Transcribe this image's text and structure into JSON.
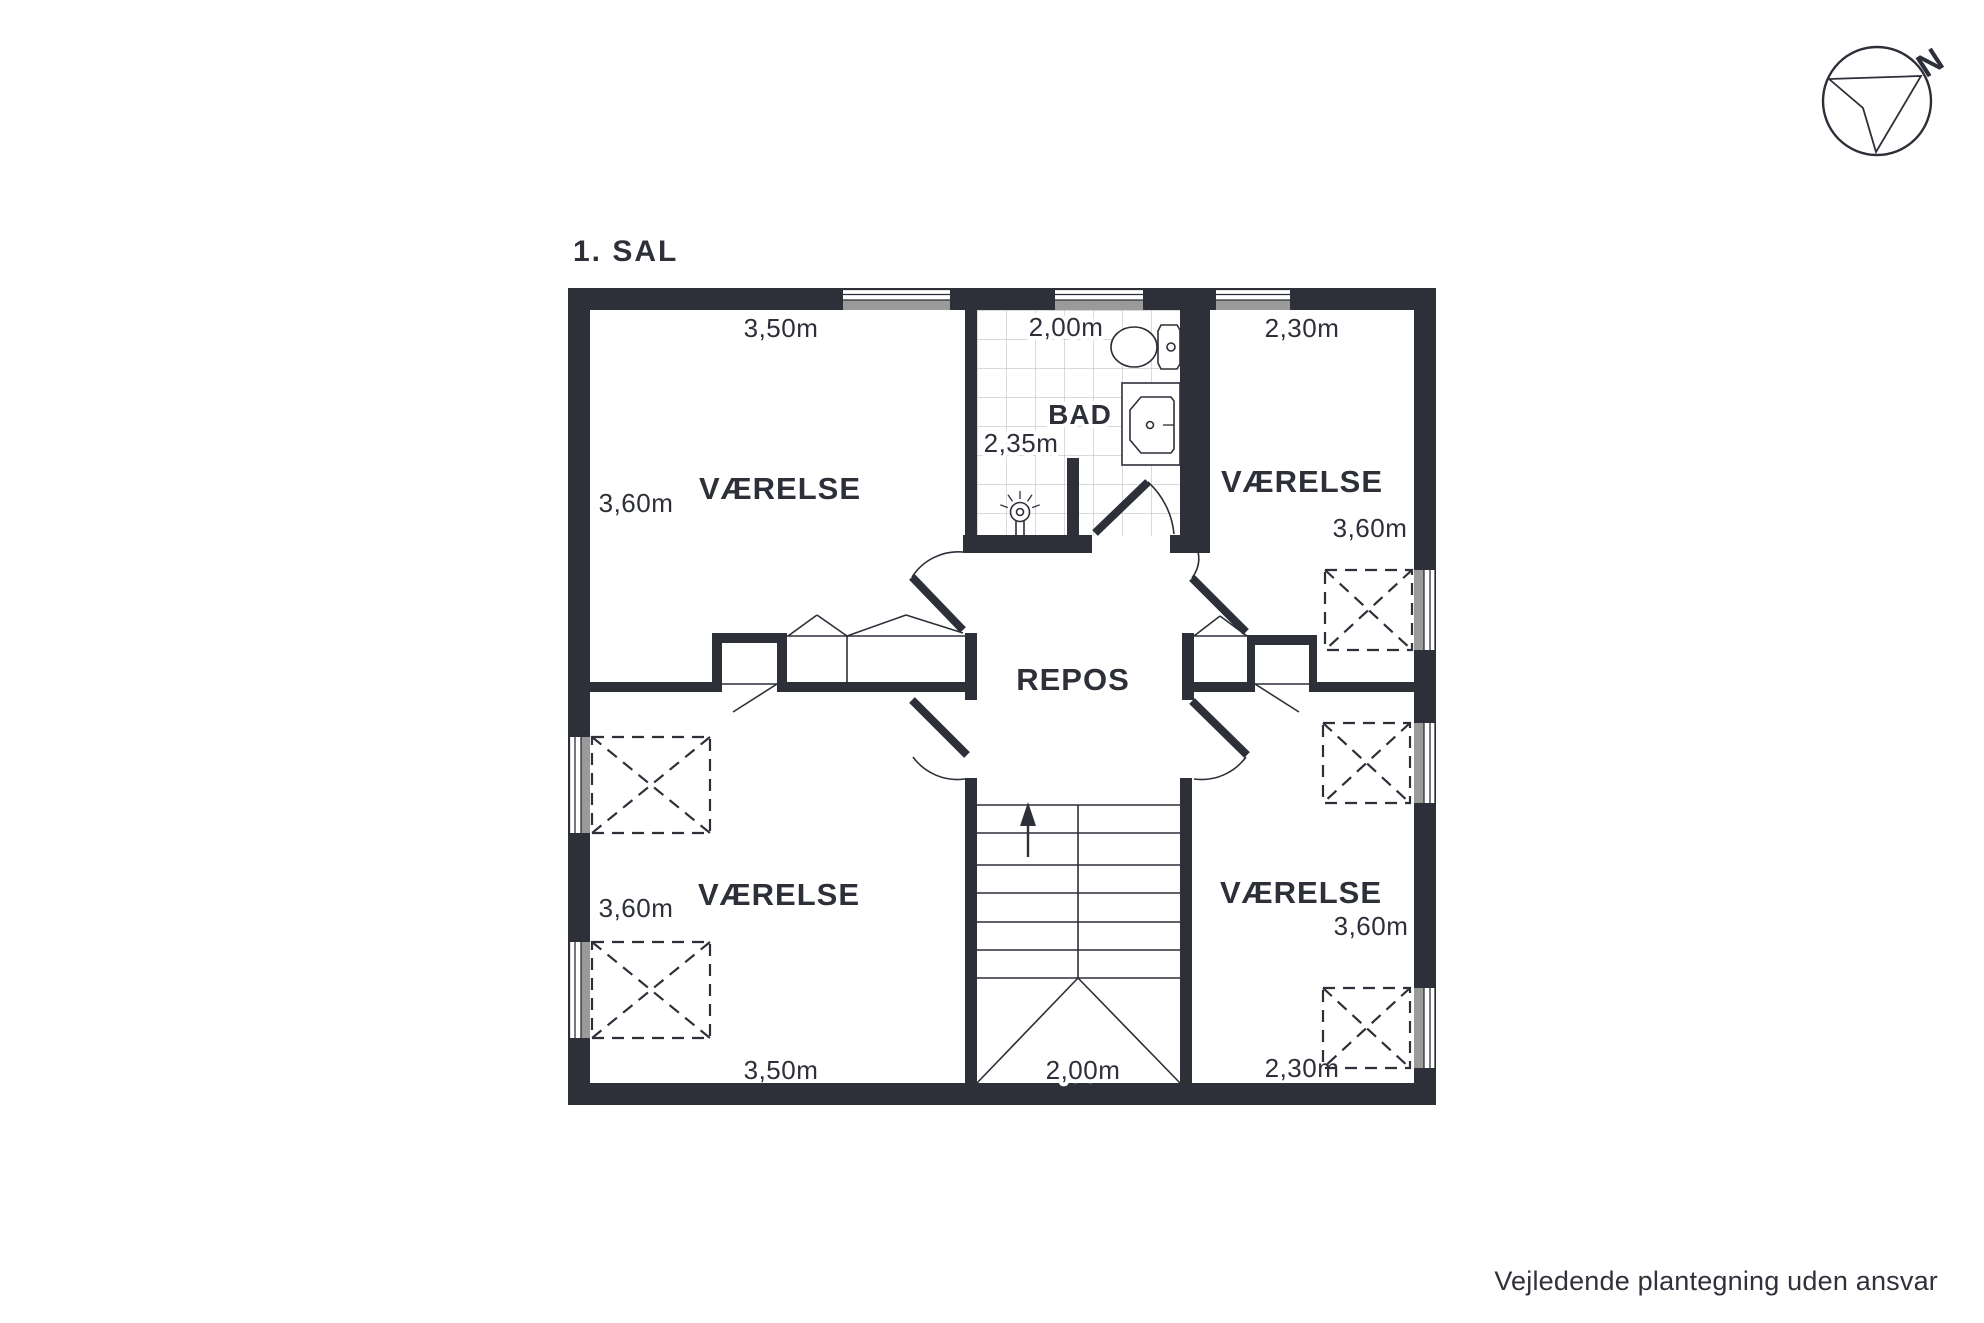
{
  "title": "1. SAL",
  "compass": {
    "north_label": "N"
  },
  "rooms": {
    "top_left": {
      "name": "VÆRELSE",
      "width_label": "3,50m",
      "depth_label": "3,60m"
    },
    "top_right": {
      "name": "VÆRELSE",
      "width_label": "2,30m",
      "depth_label": "3,60m"
    },
    "bottom_left": {
      "name": "VÆRELSE",
      "width_label": "3,50m",
      "depth_label": "3,60m"
    },
    "bottom_right": {
      "name": "VÆRELSE",
      "width_label": "2,30m",
      "depth_label": "3,60m"
    },
    "bathroom": {
      "name": "BAD",
      "width_label": "2,00m",
      "depth_label": "2,35m"
    },
    "landing": {
      "name": "REPOS"
    },
    "staircase": {
      "width_label": "2,00m"
    }
  },
  "footer": {
    "disclaimer": "Vejledende plantegning uden ansvar"
  },
  "colors": {
    "wall": "#2d2f39",
    "window_pane_gray": "#9a9a9a",
    "tile_line": "#c2c2c2",
    "text": "#2d2f39",
    "background": "#ffffff"
  }
}
